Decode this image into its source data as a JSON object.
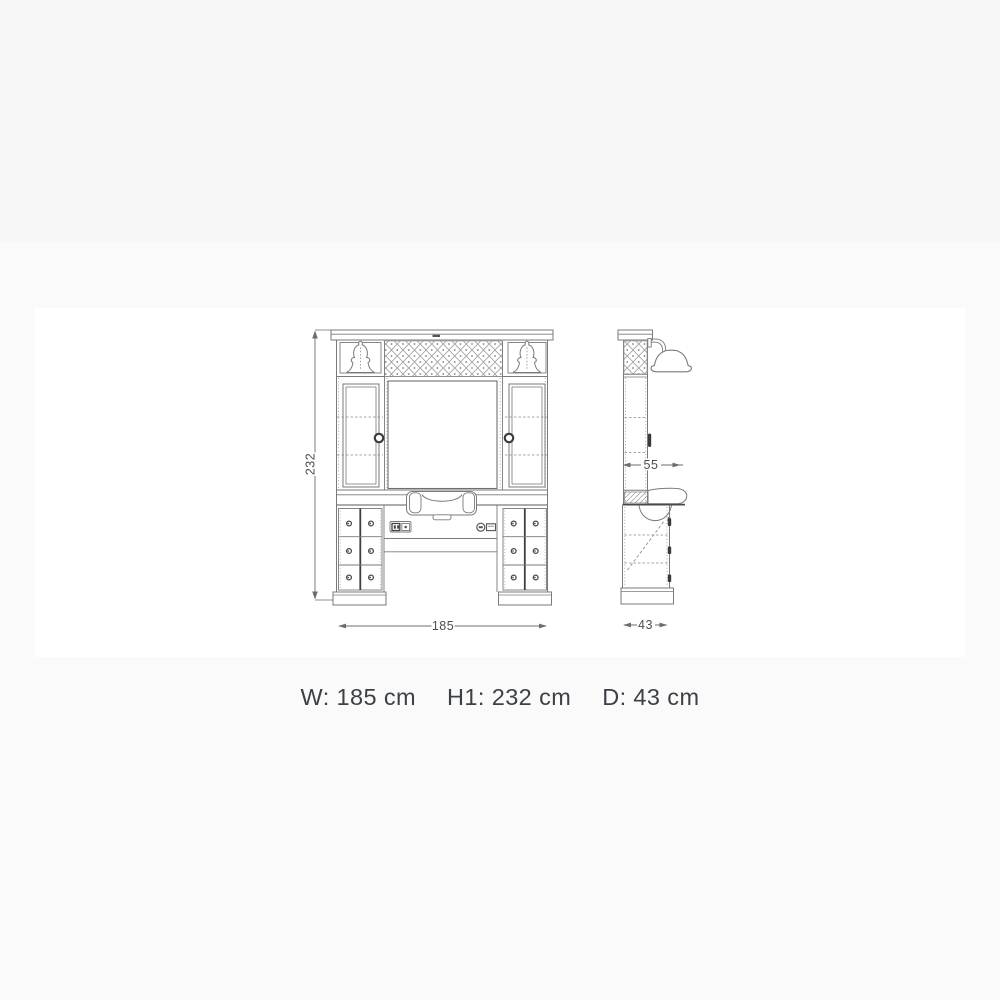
{
  "colors": {
    "page_bg": "#fafafa",
    "top_band_bg": "#f7f7f8",
    "canvas_bg": "#ffffff",
    "drawing_line": "#7a7a7a",
    "drawing_dark": "#3f3f3f",
    "dim_text": "#4d4d4d",
    "caption_text": "#3c4147"
  },
  "drawing": {
    "dims": {
      "height": "232",
      "width": "185",
      "depth_upper": "55",
      "depth_base": "43"
    }
  },
  "caption": {
    "items": [
      "W: 185 cm",
      "H1: 232 cm",
      "D: 43 cm"
    ]
  }
}
